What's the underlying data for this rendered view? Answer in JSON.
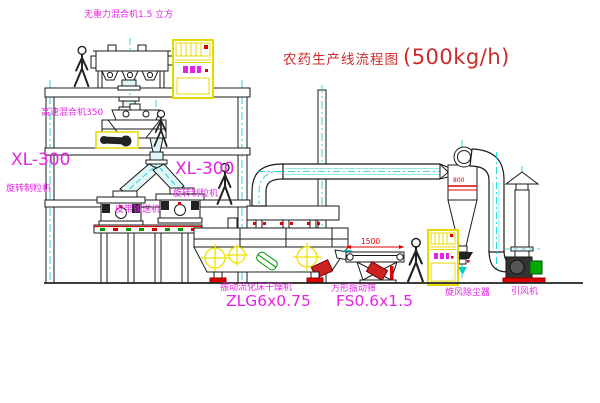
{
  "title": {
    "text": "农药生产线流程图",
    "capacity": "(500kg/h)"
  },
  "labels": {
    "gravity_mixer": "无重力混合机1.5 立方",
    "high_speed_mixer": "高速混合机350",
    "xl300_left": "XL-300",
    "xl300_left_sub": "旋转制粒机",
    "xl300_right": "XL-300",
    "xl300_right_sub": "旋转制粒机",
    "belt_conveyor": "皮带输送机",
    "fbd_name": "振动流化床干燥机",
    "fbd_model": "ZLG6x0.75",
    "screen_name": "方形振动筛",
    "screen_model": "FS0.6x1.5",
    "cyclone": "旋风除尘器",
    "fan": "引风机"
  },
  "dimensions": {
    "screen_width": "1500",
    "cyclone_diameter": "800"
  },
  "colors": {
    "label_magenta": "#e424e4",
    "title_red": "#cc2b2b",
    "dimension_red": "#dd0000",
    "line_black": "#1a1a1a",
    "centerline_cyan": "#00cccc",
    "pipe_fill": "#dff6f6",
    "cabinet_yellow": "#e8d800",
    "crosshair_yellow": "#f0e000",
    "motor_green": "#009900"
  }
}
